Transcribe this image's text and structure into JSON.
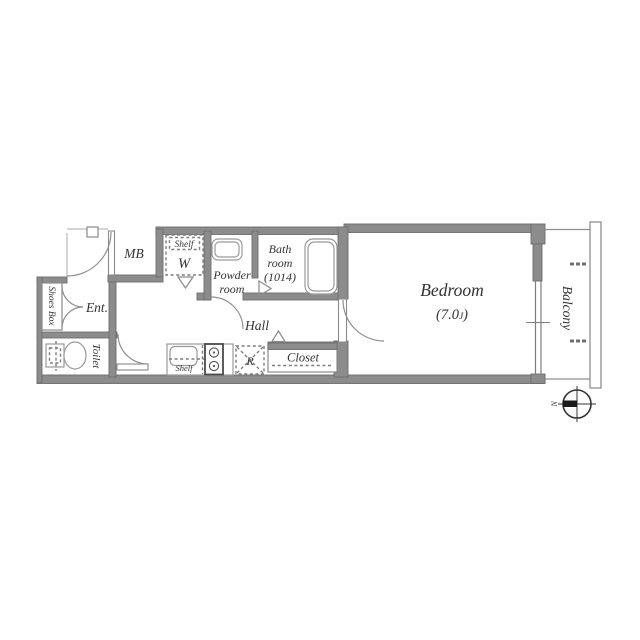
{
  "plan": {
    "title_hint": "apartment floor plan",
    "rooms": {
      "mb": {
        "label": "MB"
      },
      "washer": {
        "shelf": "Shelf",
        "w": "W"
      },
      "powder": {
        "line1": "Powder",
        "line2": "room"
      },
      "bath": {
        "line1": "Bath",
        "line2": "room",
        "line3": "(1014)"
      },
      "hall": {
        "label": "Hall"
      },
      "entrance": {
        "label": "Ent."
      },
      "shoes_box": {
        "label": "Shoes Box"
      },
      "toilet": {
        "label": "Toilet"
      },
      "kitchen": {
        "shelf": "Shelf"
      },
      "refrigerator": {
        "label": "R"
      },
      "closet": {
        "label": "Closet"
      },
      "bedroom": {
        "label": "Bedroom",
        "size_prefix": "(7.0",
        "size_unit": "J",
        "size_suffix": ")"
      },
      "balcony": {
        "label": "Balcony"
      }
    },
    "compass": {
      "north": "N"
    },
    "colors": {
      "wall": "#8c8c8c",
      "line": "#8f8f8f",
      "text": "#333333",
      "background": "#ffffff"
    }
  }
}
